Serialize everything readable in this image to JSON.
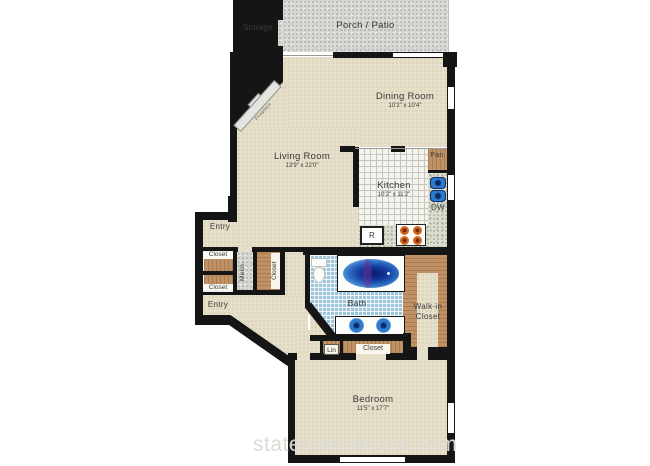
{
  "watermark": "statesrenthouse.com",
  "rooms": {
    "storage": "Storage",
    "porch": "Porch / Patio",
    "dining": {
      "name": "Dining Room",
      "dims": "10'2\" x 10'4\""
    },
    "living": {
      "name": "Living Room",
      "dims": "13'9\" x 22'0\""
    },
    "kitchen": {
      "name": "Kitchen",
      "dims": "10'2\" x 11'2\""
    },
    "bedroom": {
      "name": "Bedroom",
      "dims": "11'5\" x 17'7\""
    },
    "bath": "Bath",
    "walkin": "Walk-in Closet",
    "entry_upper": "Entry",
    "entry_lower": "Entry",
    "closet_left_top": "Closet",
    "closet_left_bottom": "Closet",
    "closet_hall": "Closet",
    "closet_bedroom": "Closet",
    "linen": "Lin",
    "mech": "Mech.",
    "pantry": "Pan.",
    "dishwasher": "DW",
    "refrigerator": "R",
    "fireplace": "Fireplace"
  },
  "colors": {
    "wall": "#151515",
    "floor_beige": "#e5dfca",
    "outdoor_gray": "#d7d6d2",
    "wood": "#bf9165",
    "bath_tile": "#9cc5da",
    "tub_blue": "#123a9c",
    "sink_blue": "#2e7bd0",
    "burner_orange": "#d2691e",
    "label_text": "#3a3a38",
    "watermark_gray": "#dad8d2"
  }
}
